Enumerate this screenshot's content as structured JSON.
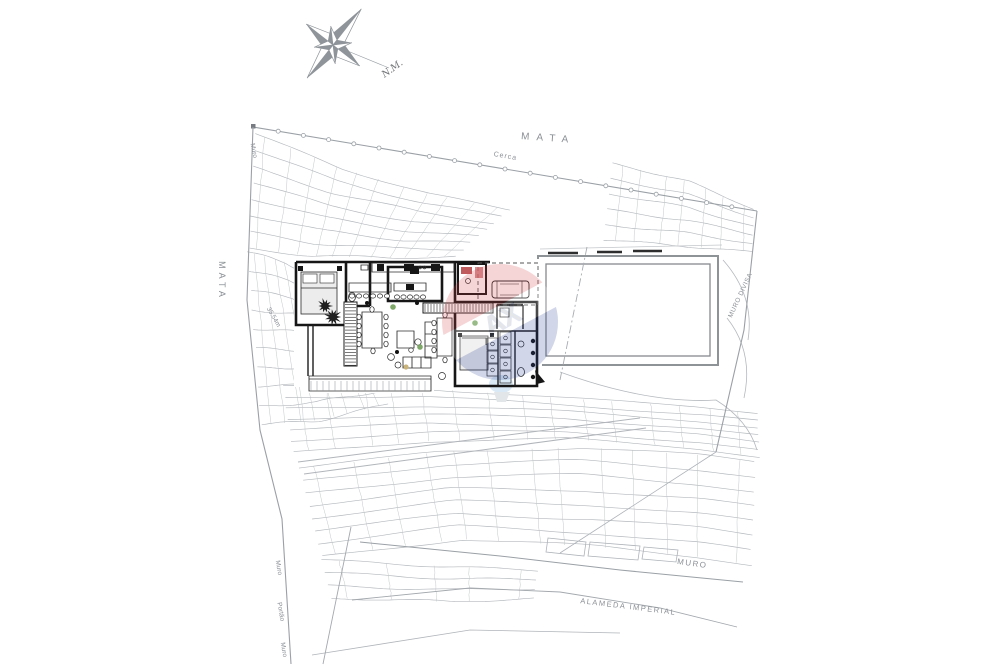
{
  "drawing": {
    "type": "architectural-site-plan",
    "labels": {
      "mata_top": "MATA",
      "mata_left": "MATA",
      "cerca": "Cerca",
      "muro_top_left": "Muro",
      "dimension": "35.54m",
      "muro_divisa": "MURO DIVISA",
      "muro_bottom_right": "MURO",
      "alameda_imperial": "ALAMEDA IMPERIAL",
      "muro_bottom_left_1": "Muro",
      "portao": "Portão",
      "muro_bottom_left_2": "Muro",
      "north_mark": "N.M."
    },
    "watermark": {
      "letters": "AX",
      "red": "#cf4046",
      "blue": "#2f4496"
    },
    "colors": {
      "contour": "#b4b8bd",
      "boundary": "#9aa0a6",
      "walls": "#161616",
      "label": "#8a8f95",
      "pool_edge": "#8e9398"
    }
  }
}
